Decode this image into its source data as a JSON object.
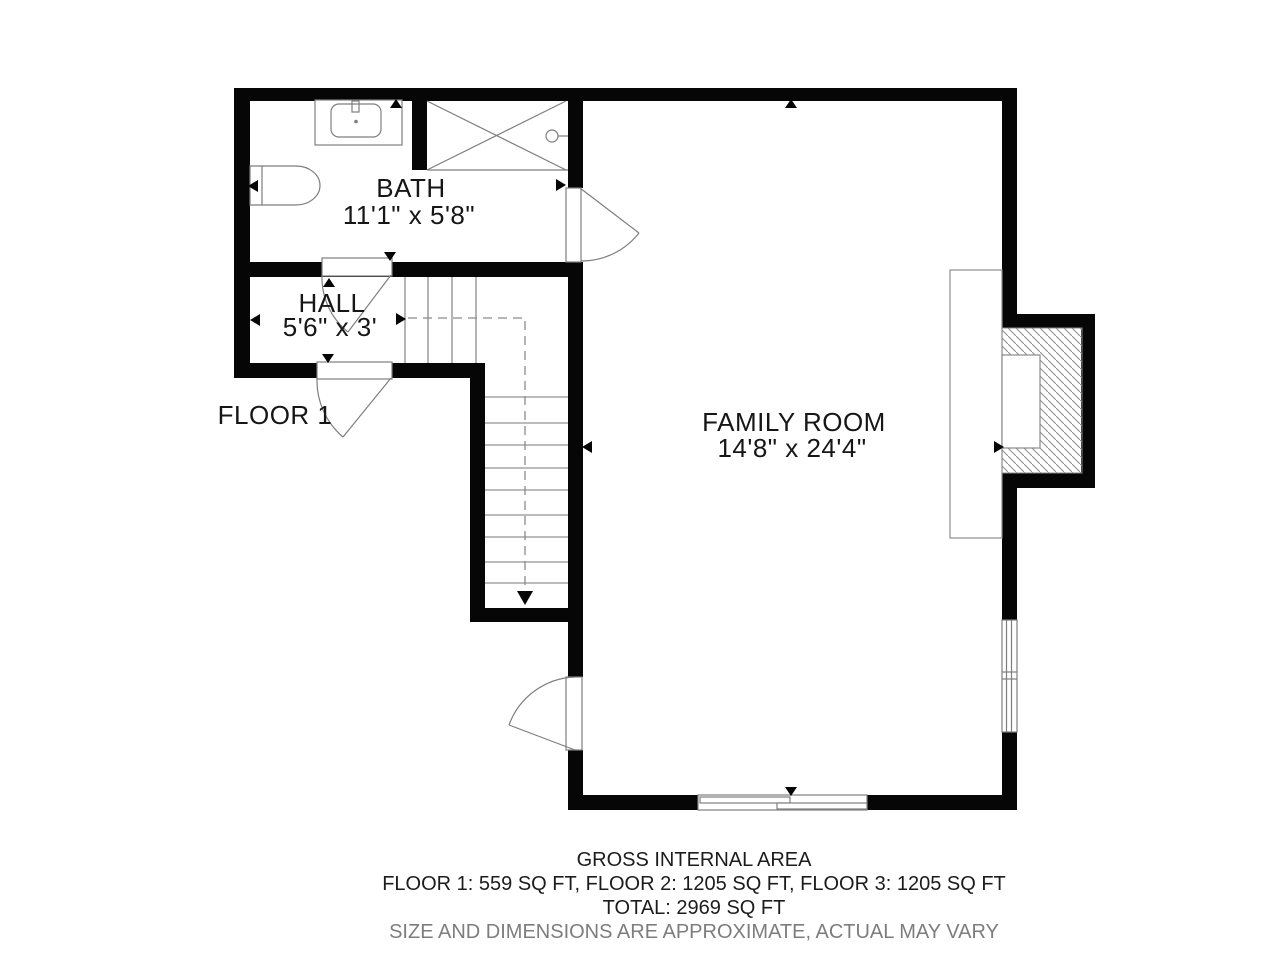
{
  "plan": {
    "floor_label": "FLOOR 1",
    "rooms": [
      {
        "name": "BATH",
        "dims": "11'1\" x 5'8\""
      },
      {
        "name": "HALL",
        "dims": "5'6\" x 3'"
      },
      {
        "name": "FAMILY ROOM",
        "dims": "14'8\" x 24'4\""
      }
    ]
  },
  "footer": {
    "title": "GROSS INTERNAL AREA",
    "floors": "FLOOR 1: 559 SQ FT, FLOOR 2: 1205 SQ FT, FLOOR 3: 1205 SQ FT",
    "total": "TOTAL: 2969 SQ FT",
    "disclaimer": "SIZE AND DIMENSIONS ARE APPROXIMATE, ACTUAL MAY VARY"
  },
  "colors": {
    "wall": "#060606",
    "fixture_line": "#7e7e7e",
    "text": "#161616",
    "muted_text": "#7d7d7d"
  }
}
